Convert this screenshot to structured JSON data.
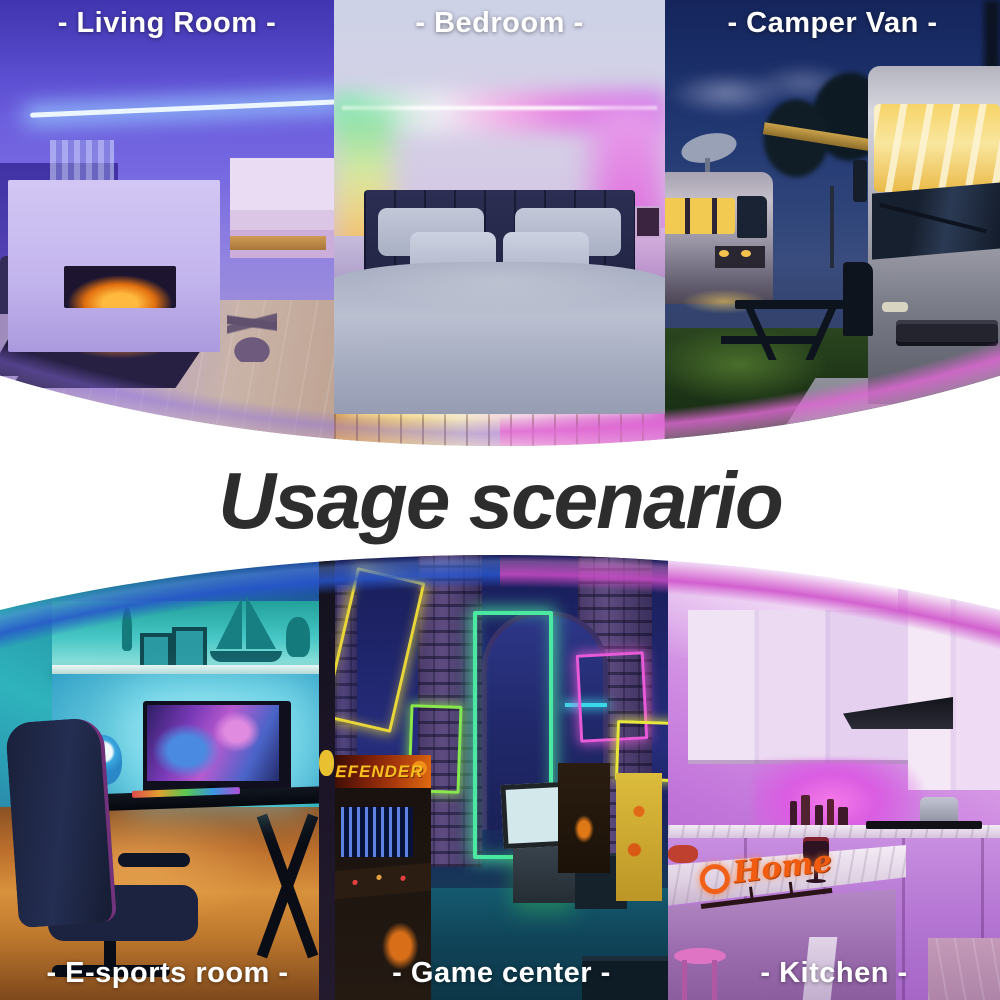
{
  "title": "Usage scenario",
  "panels": {
    "living_room": {
      "label": "- Living Room -"
    },
    "bedroom": {
      "label": "- Bedroom -"
    },
    "camper_van": {
      "label": "- Camper Van -"
    },
    "esports_room": {
      "label": "- E-sports room -"
    },
    "game_center": {
      "label": "- Game center -",
      "arcade_marquee": "DEFENDER"
    },
    "kitchen": {
      "label": "- Kitchen -",
      "decor_sign": "Home"
    }
  },
  "colors": {
    "label_text": "#ffffff",
    "title_text": "#2d2d2d",
    "living_room_accent": "#6a5ae0",
    "bedroom_accent": "#e07ae0",
    "camper_van_accent": "#f0c84e",
    "esports_accent": "#2fb3bc",
    "game_center_accent": "#4ae8a0",
    "kitchen_accent": "#cf8ae2"
  }
}
